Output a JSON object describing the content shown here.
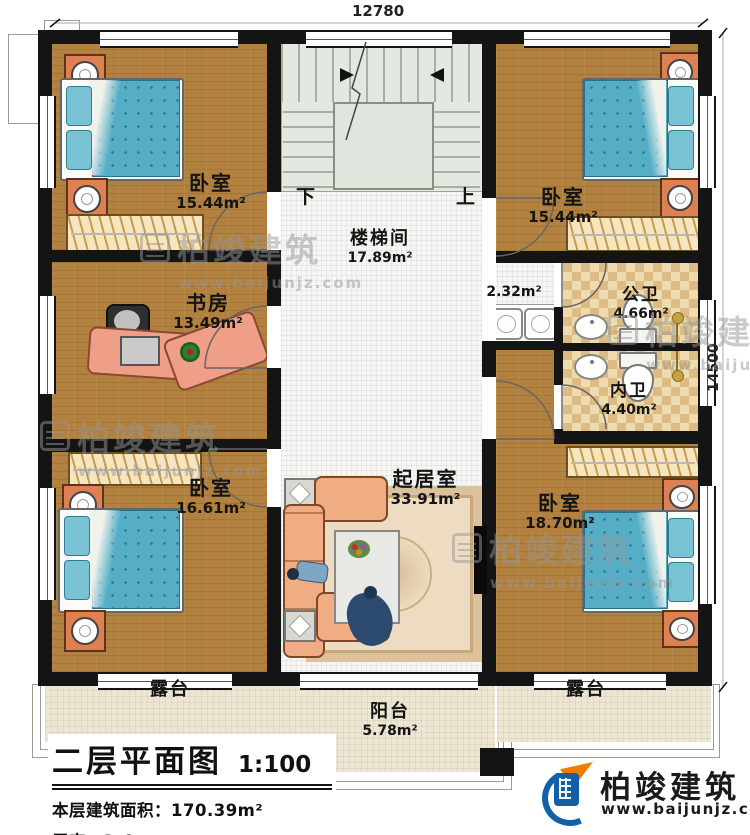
{
  "plan": {
    "dimensions": {
      "width_mm": "12780",
      "height_mm": "14500"
    },
    "stairs": {
      "label": "楼梯间",
      "area": "17.89m²",
      "down": "下",
      "up": "上"
    },
    "rooms": {
      "bedroom_tl": {
        "name": "卧室",
        "area": "15.44m²"
      },
      "bedroom_tr": {
        "name": "卧室",
        "area": "15.44m²"
      },
      "study": {
        "name": "书房",
        "area": "13.49m²"
      },
      "hallway": {
        "area": "2.32m²"
      },
      "public_bath": {
        "name": "公卫",
        "area": "4.66m²"
      },
      "ensuite_bath": {
        "name": "内卫",
        "area": "4.40m²"
      },
      "bedroom_bl": {
        "name": "卧室",
        "area": "16.61m²"
      },
      "living": {
        "name": "起居室",
        "area": "33.91m²"
      },
      "bedroom_br": {
        "name": "卧室",
        "area": "18.70m²"
      },
      "terrace_left": {
        "name": "露台"
      },
      "terrace_right": {
        "name": "露台"
      },
      "balcony": {
        "name": "阳台",
        "area": "5.78m²"
      }
    }
  },
  "title_block": {
    "title": "二层平面图",
    "scale": "1:100",
    "floor_area": "本层建筑面积：170.39m²",
    "floor_height": "层高：3.4m"
  },
  "brand": {
    "name": "柏竣建筑",
    "website": "www.baijunjz.com"
  },
  "watermark": {
    "name": "柏竣建筑",
    "website": "www.baijunjz.com"
  },
  "colors": {
    "wall": "#141414",
    "wood_floor": "#b2813f",
    "tile_floor": "#f6f6f3",
    "bath_tile": "#e7d2a0",
    "stair_floor": "#e3e8e1",
    "terrace_floor": "#ece6d2",
    "bed": "#57b0c6",
    "furniture_accent": "#dd8052",
    "brand_blue": "#1460a8",
    "brand_orange": "#f07d00"
  }
}
